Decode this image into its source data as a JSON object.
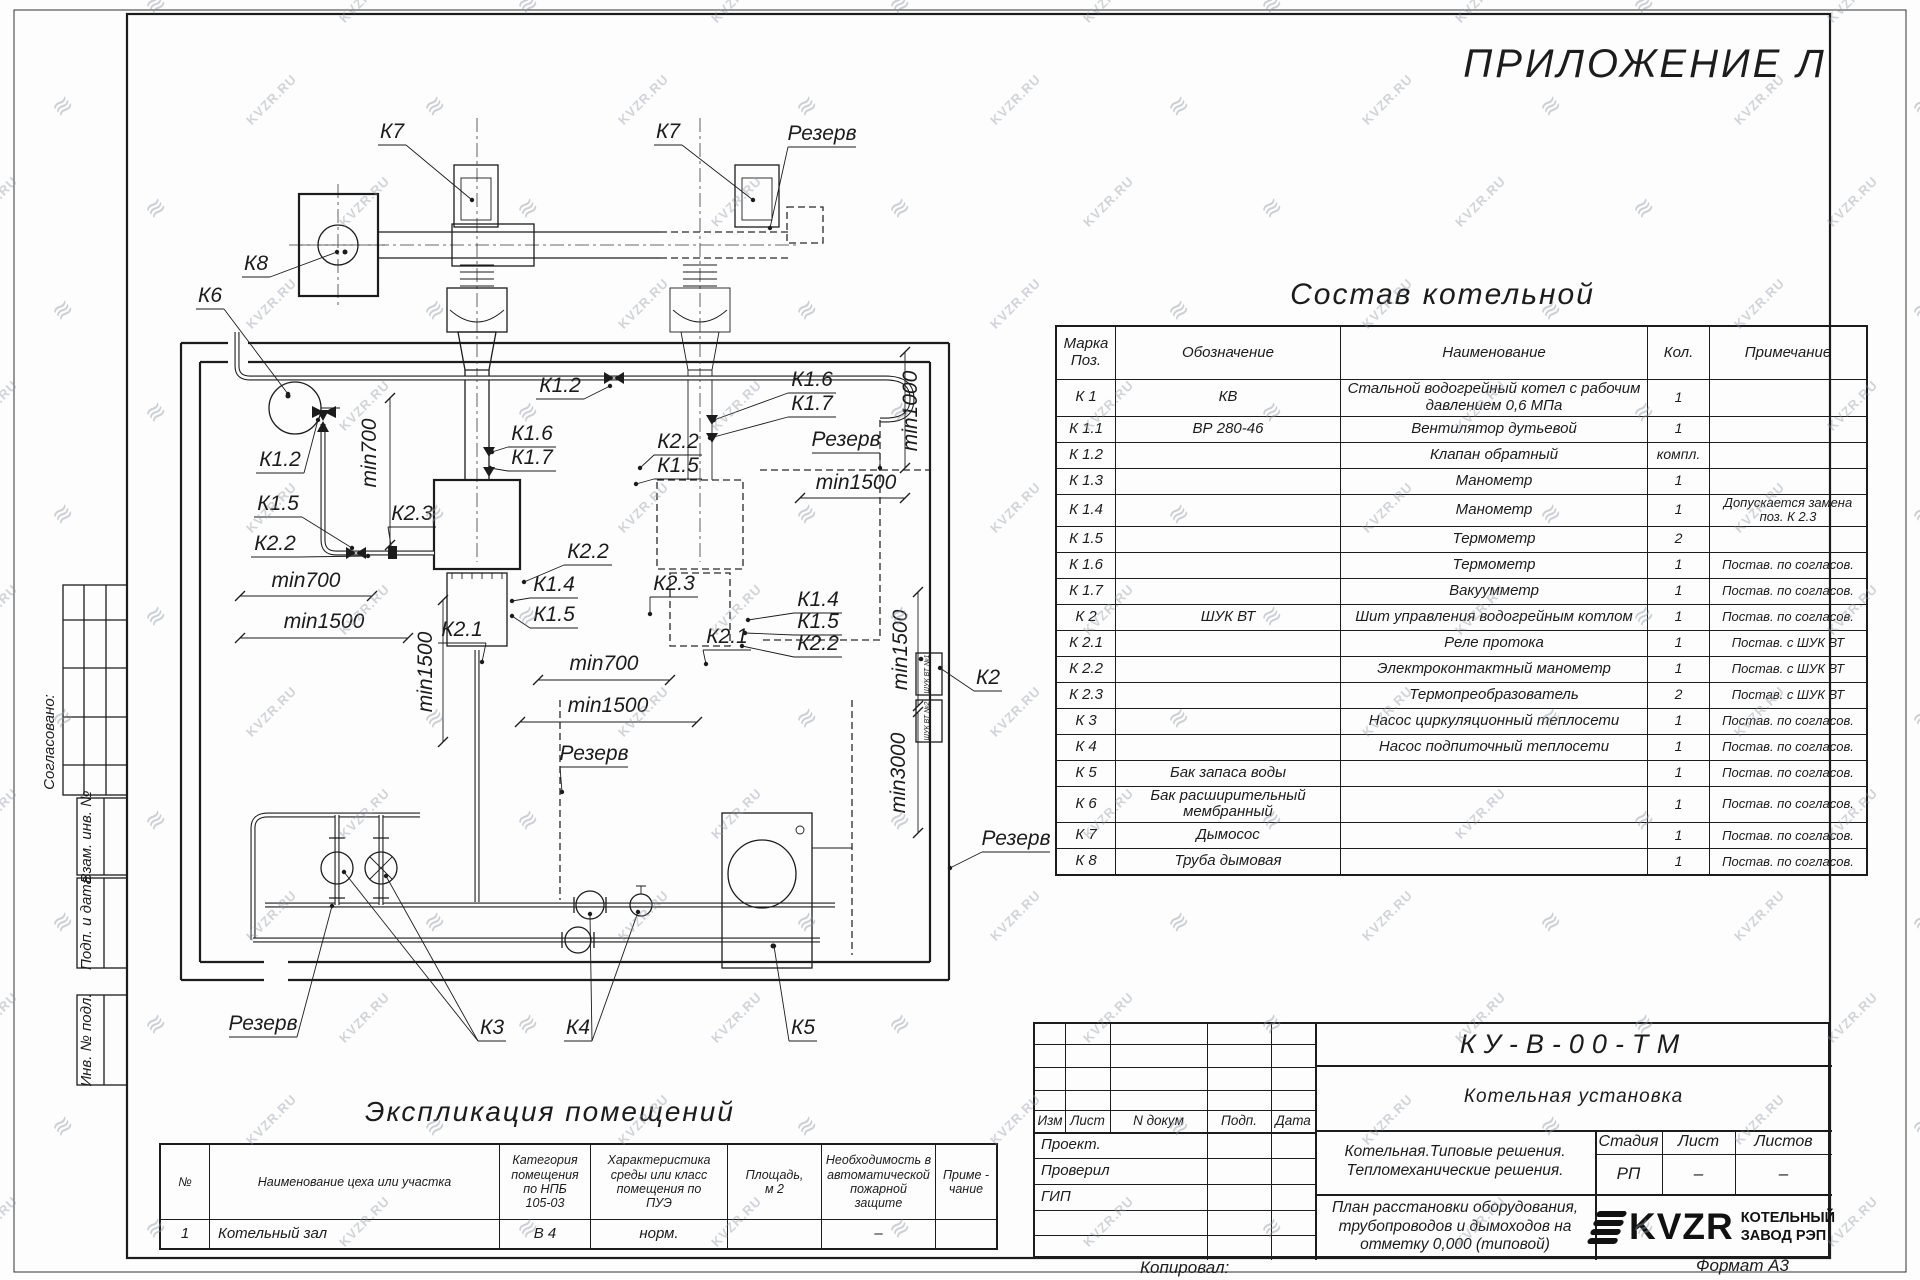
{
  "page": {
    "appendix_title": "ПРИЛОЖЕНИЕ Л",
    "copied_label": "Копировал:",
    "format_label": "Формат А3",
    "watermark_text": "KVZR.RU",
    "line_color": "#1c1c1c",
    "paper_color": "#fdfdfd"
  },
  "left_margin": {
    "labels": [
      {
        "t": "Согласовано:",
        "x": 54,
        "y": 742,
        "fs": 17
      },
      {
        "t": "Взам. инв. №",
        "x": 91,
        "y": 837,
        "fs": 14
      },
      {
        "t": "Подп. и дата",
        "x": 91,
        "y": 923,
        "fs": 14
      },
      {
        "t": "Инв. № подл.",
        "x": 91,
        "y": 1040,
        "fs": 14
      }
    ]
  },
  "composition_table": {
    "title": "Состав котельной",
    "headers": [
      "Марка Поз.",
      "Обозначение",
      "Наименование",
      "Кол.",
      "Примечание"
    ],
    "rows": [
      [
        "К 1",
        "КВ",
        "Стальной водогрейный котел с рабочим давлением 0,6 МПа",
        "1",
        ""
      ],
      [
        "К 1.1",
        "ВР 280-46",
        "Вентилятор дутьевой",
        "1",
        ""
      ],
      [
        "К 1.2",
        "",
        "Клапан обратный",
        "компл.",
        ""
      ],
      [
        "К 1.3",
        "",
        "Манометр",
        "1",
        ""
      ],
      [
        "К 1.4",
        "",
        "Манометр",
        "1",
        "Допускается замена поз. К 2.3"
      ],
      [
        "К 1.5",
        "",
        "Термометр",
        "2",
        ""
      ],
      [
        "К 1.6",
        "",
        "Термометр",
        "1",
        "Постав. по согласов."
      ],
      [
        "К 1.7",
        "",
        "Вакуумметр",
        "1",
        "Постав. по согласов."
      ],
      [
        "К 2",
        "ШУК ВТ",
        "Шит управления водогрейным котлом",
        "1",
        "Постав. по согласов."
      ],
      [
        "К 2.1",
        "",
        "Реле протока",
        "1",
        "Постав. с ШУК ВТ"
      ],
      [
        "К 2.2",
        "",
        "Электроконтактный манометр",
        "1",
        "Постав. с ШУК ВТ"
      ],
      [
        "К 2.3",
        "",
        "Термопреобразователь",
        "2",
        "Постав. с ШУК ВТ"
      ],
      [
        "К 3",
        "",
        "Насос циркуляционный теплосети",
        "1",
        "Постав. по согласов."
      ],
      [
        "К 4",
        "",
        "Насос подпиточный теплосети",
        "1",
        "Постав. по согласов."
      ],
      [
        "К 5",
        "Бак запаса воды",
        "",
        "1",
        "Постав. по согласов."
      ],
      [
        "К 6",
        "Бак расширительный мембранный",
        "",
        "1",
        "Постав. по согласов."
      ],
      [
        "К 7",
        "Дымосос",
        "",
        "1",
        "Постав. по согласов."
      ],
      [
        "К 8",
        "Труба дымовая",
        "",
        "1",
        "Постав. по согласов."
      ]
    ]
  },
  "explication_table": {
    "title": "Экспликация помещений",
    "headers": [
      "№",
      "Наименование цеха или участка",
      "Категория\nпомещения\nпо НПБ\n105-03",
      "Характеристика\nсреды или класс\nпомещения по\nПУЭ",
      "Площадь,\nм 2",
      "Необходимость в\nавтоматической\nпожарной защите",
      "Приме -\nчание"
    ],
    "rows": [
      [
        "1",
        "Котельный зал",
        "В 4",
        "норм.",
        "",
        "–",
        ""
      ]
    ]
  },
  "title_block": {
    "doc_code": "КУ-В-00-ТМ",
    "object_name": "Котельная установка",
    "project_name": "Котельная.Типовые решения.\nТепломеханические решения.",
    "sheet_name": "План расстановки оборудования,\nтрубопроводов и дымоходов на\nотметку 0,000 (типовой)",
    "rev_headers": [
      "Изм",
      "Лист",
      "N докум",
      "Подп.",
      "Дата"
    ],
    "roles": [
      "Проект.",
      "Проверил",
      "ГИП"
    ],
    "stage_label": "Стадия",
    "sheet_label": "Лист",
    "sheets_label": "Листов",
    "stage_value": "РП",
    "sheet_value": "–",
    "sheets_value": "–",
    "company_logo": "KVZR",
    "company_name": "КОТЕЛЬНЫЙ\nЗАВОД РЭП"
  },
  "plan": {
    "shuk_labels": [
      {
        "t": "ШУК ВТ №1",
        "x": 929,
        "y": 674
      },
      {
        "t": "ШУК ВТ №2",
        "x": 929,
        "y": 721
      }
    ],
    "labels": [
      {
        "t": "К7",
        "x": 392,
        "y": 138,
        "lx": 472,
        "ly": 200
      },
      {
        "t": "К7",
        "x": 668,
        "y": 138,
        "lx": 753,
        "ly": 200
      },
      {
        "t": "Резерв",
        "x": 822,
        "y": 140,
        "u": 1,
        "lx": 770,
        "ly": 228
      },
      {
        "t": "К8",
        "x": 256,
        "y": 270,
        "lx": 337,
        "ly": 252
      },
      {
        "t": "К6",
        "x": 210,
        "y": 302,
        "lx": 288,
        "ly": 394
      },
      {
        "t": "К1.2",
        "x": 560,
        "y": 392,
        "lx": 610,
        "ly": 386
      },
      {
        "t": "К1.6",
        "x": 812,
        "y": 386,
        "lx": 714,
        "ly": 420
      },
      {
        "t": "К1.7",
        "x": 812,
        "y": 410,
        "lx": 710,
        "ly": 438
      },
      {
        "t": "min700",
        "x": 376,
        "y": 453,
        "rot": -90
      },
      {
        "t": "min1000",
        "x": 917,
        "y": 411,
        "rot": -90
      },
      {
        "t": "К1.6",
        "x": 532,
        "y": 440,
        "lx": 492,
        "ly": 452
      },
      {
        "t": "К1.7",
        "x": 532,
        "y": 464,
        "lx": 490,
        "ly": 468
      },
      {
        "t": "К2.2",
        "x": 678,
        "y": 448,
        "lx": 640,
        "ly": 468
      },
      {
        "t": "К1.5",
        "x": 678,
        "y": 472,
        "lx": 636,
        "ly": 484
      },
      {
        "t": "Резерв",
        "x": 846,
        "y": 446,
        "u": 1,
        "lx": 880,
        "ly": 468
      },
      {
        "t": "min1500",
        "x": 856,
        "y": 489
      },
      {
        "t": "К1.2",
        "x": 280,
        "y": 466,
        "lx": 318,
        "ly": 420
      },
      {
        "t": "К1.5",
        "x": 278,
        "y": 510,
        "lx": 352,
        "ly": 548
      },
      {
        "t": "К2.2",
        "x": 275,
        "y": 550,
        "lx": 368,
        "ly": 556
      },
      {
        "t": "К2.3",
        "x": 412,
        "y": 520,
        "lx": 392,
        "ly": 552
      },
      {
        "t": "min700",
        "x": 306,
        "y": 587
      },
      {
        "t": "К2.2",
        "x": 588,
        "y": 558,
        "lx": 524,
        "ly": 582
      },
      {
        "t": "К1.4",
        "x": 554,
        "y": 591,
        "lx": 512,
        "ly": 601
      },
      {
        "t": "К1.5",
        "x": 554,
        "y": 621,
        "lx": 512,
        "ly": 616
      },
      {
        "t": "min1500",
        "x": 324,
        "y": 628
      },
      {
        "t": "К2.1",
        "x": 462,
        "y": 636,
        "lx": 482,
        "ly": 662
      },
      {
        "t": "К2.3",
        "x": 674,
        "y": 590,
        "lx": 650,
        "ly": 614
      },
      {
        "t": "min700",
        "x": 604,
        "y": 670
      },
      {
        "t": "К1.4",
        "x": 818,
        "y": 606,
        "lx": 748,
        "ly": 620
      },
      {
        "t": "К1.5",
        "x": 818,
        "y": 628,
        "lx": 745,
        "ly": 633
      },
      {
        "t": "К2.2",
        "x": 818,
        "y": 650,
        "lx": 742,
        "ly": 646
      },
      {
        "t": "К2.1",
        "x": 727,
        "y": 643,
        "lx": 706,
        "ly": 664
      },
      {
        "t": "min1500",
        "x": 432,
        "y": 672,
        "rot": -90
      },
      {
        "t": "min1500",
        "x": 907,
        "y": 650,
        "rot": -90
      },
      {
        "t": "min1500",
        "x": 608,
        "y": 712
      },
      {
        "t": "К2",
        "x": 988,
        "y": 684,
        "lx": 940,
        "ly": 668
      },
      {
        "t": "Резерв",
        "x": 594,
        "y": 760,
        "u": 1,
        "lx": 562,
        "ly": 792
      },
      {
        "t": "min3000",
        "x": 905,
        "y": 773,
        "rot": -90
      },
      {
        "t": "Резерв",
        "x": 1016,
        "y": 845,
        "u": 1,
        "lx": 950,
        "ly": 868
      },
      {
        "t": "Резерв",
        "x": 263,
        "y": 1030,
        "u": 1,
        "lx": 332,
        "ly": 906
      },
      {
        "t": "К3",
        "x": 492,
        "y": 1034,
        "lx": 344,
        "ly": 872,
        "lx2": 386,
        "ly2": 876
      },
      {
        "t": "К4",
        "x": 578,
        "y": 1034,
        "lx": 590,
        "ly": 914,
        "lx2": 638,
        "ly2": 912
      },
      {
        "t": "К5",
        "x": 803,
        "y": 1034,
        "lx": 774,
        "ly": 946
      }
    ]
  }
}
